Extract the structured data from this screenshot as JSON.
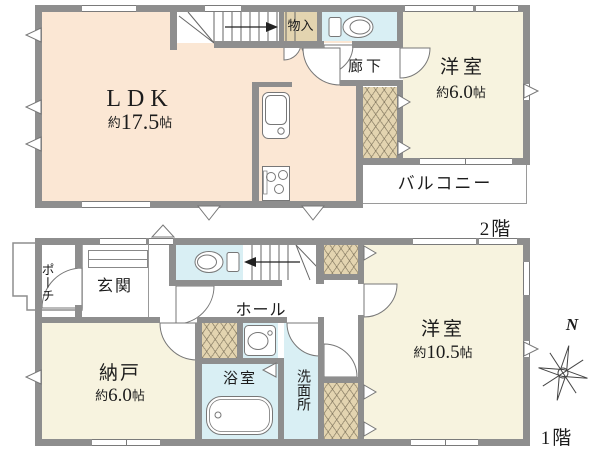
{
  "colors": {
    "wall": "#8e8e8e",
    "ldk_fill": "#fbe7d4",
    "western_fill": "#f7f3df",
    "wet_fill": "#d9eff4",
    "closet_fill": "#e3d4b0",
    "line": "#777777",
    "text": "#1c1c1c"
  },
  "floor2": {
    "label": "2階",
    "ldk": {
      "name": "LDK",
      "area_prefix": "約",
      "area_value": "17.5",
      "area_unit": "帖"
    },
    "storage": "物入",
    "corridor": "廊下",
    "western_room": {
      "name": "洋室",
      "area_prefix": "約",
      "area_value": "6.0",
      "area_unit": "帖"
    },
    "balcony": "バルコニー"
  },
  "floor1": {
    "label": "1階",
    "porch": "ポーチ",
    "entrance": "玄関",
    "hall": "ホール",
    "storage_room": {
      "name": "納戸",
      "area_prefix": "約",
      "area_value": "6.0",
      "area_unit": "帖"
    },
    "bathroom": "浴室",
    "washroom": "洗面所",
    "western_room": {
      "name": "洋室",
      "area_prefix": "約",
      "area_value": "10.5",
      "area_unit": "帖"
    },
    "compass": "N"
  }
}
